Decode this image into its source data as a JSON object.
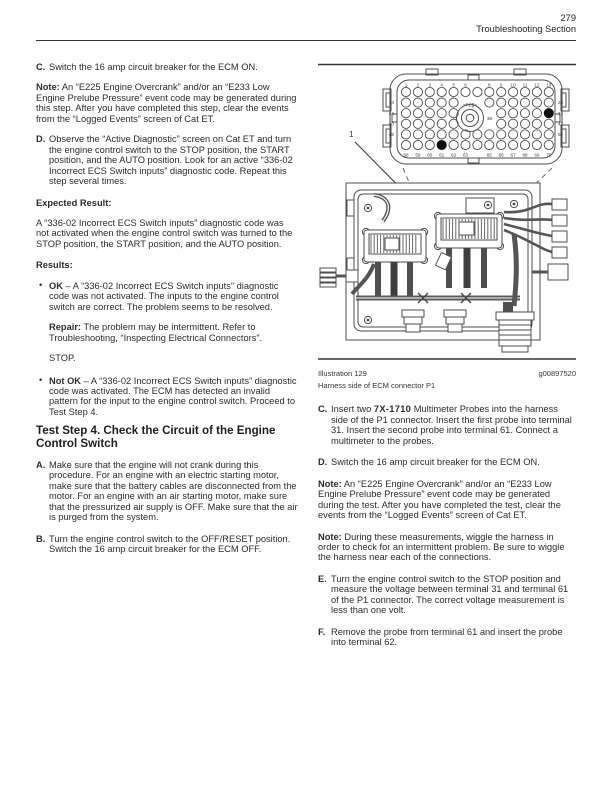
{
  "header": {
    "page_number": "279",
    "section": "Troubleshooting Section"
  },
  "left": {
    "stepC": {
      "label": "C.",
      "text": "Switch the 16 amp circuit breaker for the ECM ON."
    },
    "note1": {
      "label": "Note:",
      "text": "An “E225 Engine Overcrank” and/or an “E233 Low Engine Prelube Pressure” event code may be generated during this step. After you have completed this step, clear the events from the “Logged Events” screen of Cat ET."
    },
    "stepD": {
      "label": "D.",
      "text": "Observe the “Active Diagnostic” screen on Cat ET and turn the engine control switch to the STOP position, the START position, and the AUTO position. Look for an active “336-02 Incorrect ECS Switch inputs” diagnostic code. Repeat this step several times."
    },
    "expected_heading": "Expected Result:",
    "expected_text": "A “336-02 Incorrect ECS Switch inputs” diagnostic code was not activated when the engine control switch was turned to the STOP position, the START position, and the AUTO position.",
    "results_heading": "Results:",
    "bullet_ok": {
      "bullet": "•",
      "label": "OK",
      "dash": "–",
      "text": "A “336-02 Incorrect ECS Switch inputs” diagnostic code was not activated. The inputs to the engine control switch are correct. The problem seems to be resolved."
    },
    "repair": {
      "label": "Repair:",
      "text": "The problem may be intermittent. Refer to Troubleshooting, “Inspecting Electrical Connectors”."
    },
    "stop_text": "STOP.",
    "bullet_notok": {
      "bullet": "•",
      "label": "Not OK",
      "dash": "–",
      "text": "A “336-02 Incorrect ECS Switch inputs” diagnostic code was activated. The ECM has detected an invalid pattern for the input to the engine control switch. Proceed to Test Step 4."
    },
    "test_step_heading": "Test Step 4. Check the Circuit of the Engine Control Switch",
    "stepA": {
      "label": "A.",
      "text": "Make sure that the engine will not crank during this procedure. For an engine with an electric starting motor, make sure that the battery cables are disconnected from the motor. For an engine with an air starting motor, make sure that the pressurized air supply is OFF. Make sure that the air is purged from the system."
    },
    "stepB": {
      "label": "B.",
      "text": "Turn the engine control switch to the OFF/RESET position. Switch the 16 amp circuit breaker for the ECM OFF."
    }
  },
  "illustration": {
    "callout": "1",
    "figure_number": "Illustration 129",
    "figure_id": "g00897520",
    "caption": "Harness side of ECM connector P1",
    "connector": {
      "top_pins": [
        "1",
        "2",
        "3",
        "4",
        "5",
        "6",
        "8",
        "9",
        "10",
        "11",
        "12",
        "13"
      ],
      "bottom_pins": [
        "58",
        "59",
        "60",
        "61",
        "62",
        "63",
        "65",
        "66",
        "67",
        "68",
        "69",
        "70"
      ],
      "left_pins": [
        "14",
        "24",
        "40",
        "48"
      ],
      "right_pins": [
        "23",
        "31",
        "47",
        "57"
      ],
      "center_mark": ">PE[]<",
      "center_pin": "36",
      "highlighted_pins": [
        "31",
        "61"
      ]
    }
  },
  "right": {
    "stepC": {
      "label": "C.",
      "text_before": "Insert two ",
      "part_number": "7X-1710",
      "text_after": " Multimeter Probes into the harness side of the P1 connector. Insert the first probe into terminal 31. Insert the second probe into terminal 61. Connect a multimeter to the probes."
    },
    "stepD": {
      "label": "D.",
      "text": "Switch the 16 amp circuit breaker for the ECM ON."
    },
    "note1": {
      "label": "Note:",
      "text": "An “E225 Engine Overcrank” and/or an “E233 Low Engine Prelube Pressure” event code may be generated during the test. After you have completed the test, clear the events from the “Logged Events” screen of Cat ET."
    },
    "note2": {
      "label": "Note:",
      "text": "During these measurements, wiggle the harness in order to check for an intermittent problem. Be sure to wiggle the harness near each of the connections."
    },
    "stepE": {
      "label": "E.",
      "text": "Turn the engine control switch to the STOP position and measure the voltage between terminal 31 and terminal 61 of the P1 connector. The correct voltage measurement is less than one volt."
    },
    "stepF": {
      "label": "F.",
      "text": "Remove the probe from terminal 61 and insert the probe into terminal 62."
    }
  },
  "colors": {
    "text": "#2b2b2b",
    "line": "#4d4d4d",
    "fill_pin": "#111111"
  }
}
